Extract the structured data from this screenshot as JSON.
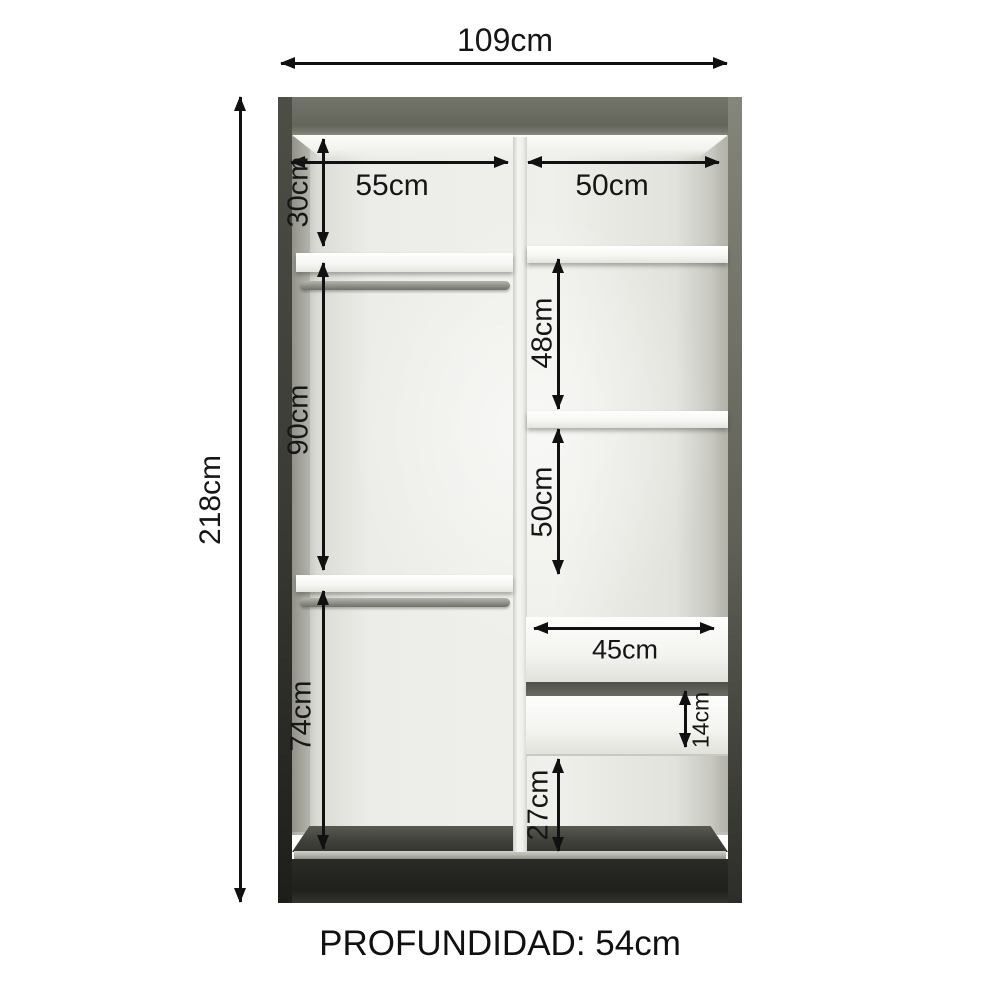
{
  "diagram": {
    "type": "furniture-dimension-diagram",
    "subject": "wardrobe interior",
    "footer": "PROFUNDIDAD: 54cm"
  },
  "labels": {
    "total_width": "109cm",
    "total_height": "218cm",
    "left_section_width": "55cm",
    "right_section_width": "50cm",
    "top_shelf_height": "30cm",
    "left_hanging_height": "90cm",
    "left_bottom_height": "74cm",
    "right_upper_height": "48cm",
    "right_middle_height": "50cm",
    "drawer_width": "45cm",
    "drawer_front_height": "14cm",
    "bottom_right_height": "27cm"
  },
  "colors": {
    "annotation_line": "#111111",
    "cabinet_top_panel": "#686a5e",
    "cabinet_plinth": "#21221e",
    "interior_back": "#ecece8",
    "shelf_white": "#f6f6f3",
    "floor_dark": "#3f4039",
    "background": "#ffffff"
  }
}
